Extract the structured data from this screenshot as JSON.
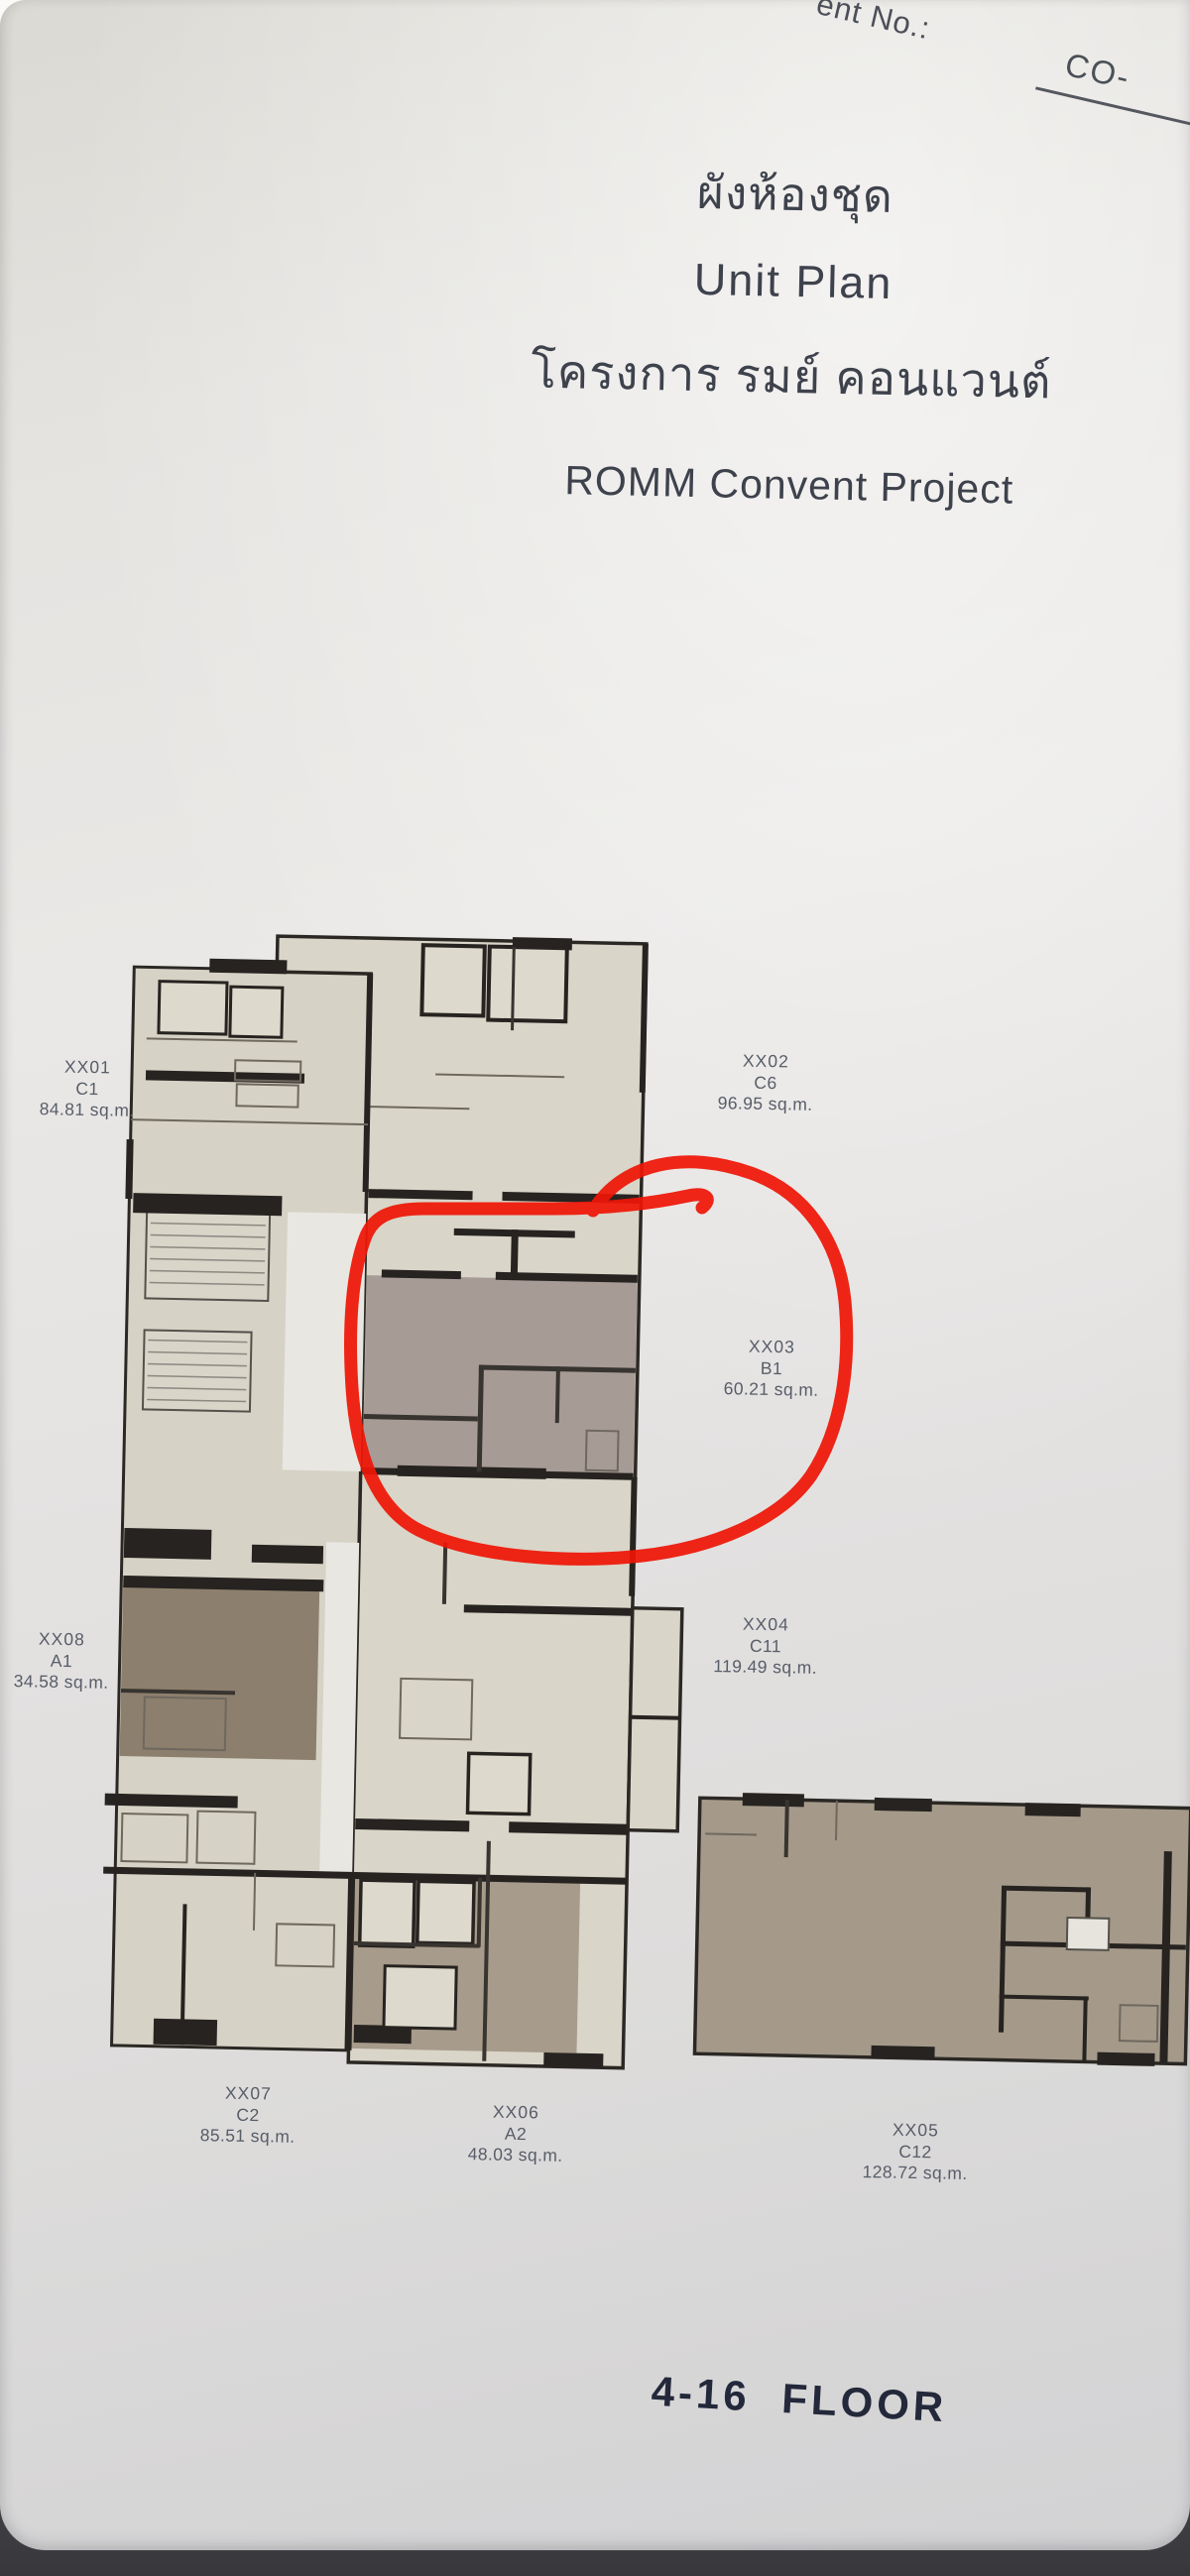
{
  "header_note": {
    "prefix": "ent No.:",
    "value": "CO-"
  },
  "titles": {
    "thai_title": "ผังห้องชุด",
    "english_title": "Unit Plan",
    "thai_project": "โครงการ รมย์ คอนแวนต์",
    "english_project": "ROMM Convent Project"
  },
  "units": [
    {
      "id": "XX01",
      "type": "C1",
      "area": "84.81 sq.m."
    },
    {
      "id": "XX02",
      "type": "C6",
      "area": "96.95 sq.m."
    },
    {
      "id": "XX03",
      "type": "B1",
      "area": "60.21 sq.m."
    },
    {
      "id": "XX04",
      "type": "C11",
      "area": "119.49 sq.m."
    },
    {
      "id": "XX05",
      "type": "C12",
      "area": "128.72 sq.m."
    },
    {
      "id": "XX06",
      "type": "A2",
      "area": "48.03 sq.m."
    },
    {
      "id": "XX07",
      "type": "C2",
      "area": "85.51 sq.m."
    },
    {
      "id": "XX08",
      "type": "A1",
      "area": "34.58 sq.m."
    }
  ],
  "floor_label": "4-16 FLOOR",
  "annotation": {
    "shape": "hand-drawn circle",
    "color": "#ee1606",
    "around": "XX03"
  },
  "colors": {
    "wall": "#262320",
    "cream": "#d8d4c7",
    "mauve": "#a79b96",
    "brown": "#8d7f6d",
    "tan": "#a59a8a",
    "label_text": "#585d68",
    "title_text": "#3e424c",
    "floor_text": "#23283a"
  }
}
